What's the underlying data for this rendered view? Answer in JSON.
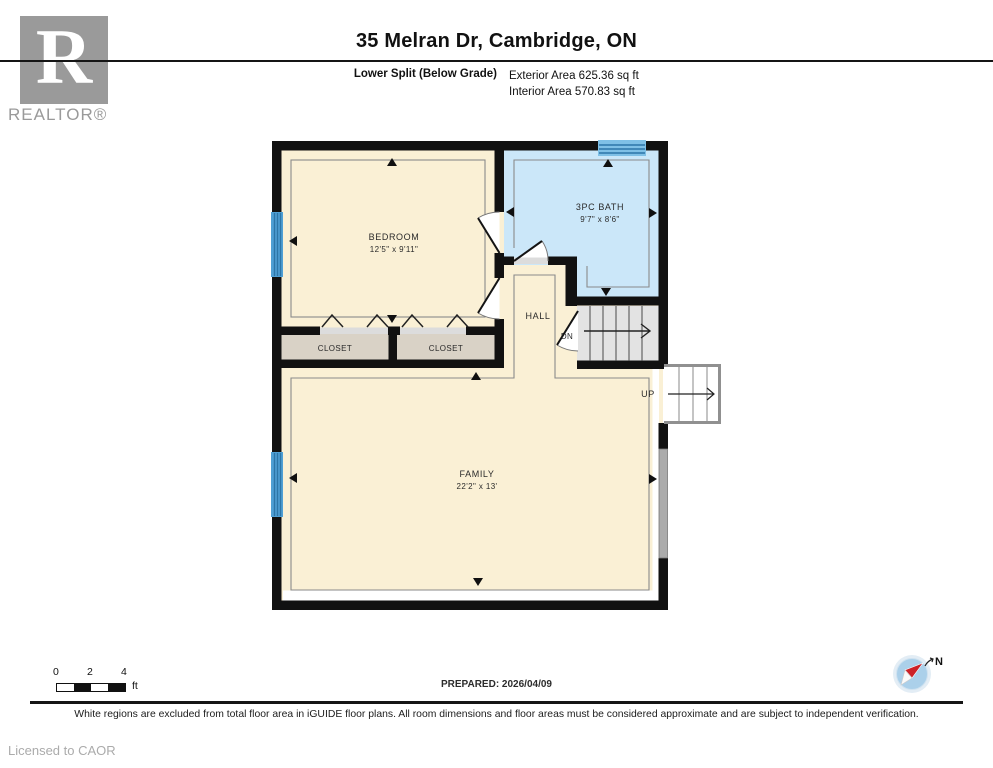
{
  "header": {
    "title": "35 Melran Dr, Cambridge, ON",
    "floor_label": "Lower Split (Below Grade)",
    "exterior_area": "Exterior Area 625.36 sq ft",
    "interior_area": "Interior Area 570.83 sq ft",
    "logo_letter": "R",
    "logo_wordmark": "REALTOR®"
  },
  "floorplan": {
    "rooms": {
      "bedroom": {
        "name": "BEDROOM",
        "dims": "12'5\" x 9'11\""
      },
      "bath": {
        "name": "3PC BATH",
        "dims": "9'7\" x 8'6\""
      },
      "family": {
        "name": "FAMILY",
        "dims": "22'2\" x 13'"
      },
      "hall": {
        "name": "HALL"
      },
      "closet_left": {
        "name": "CLOSET"
      },
      "closet_right": {
        "name": "CLOSET"
      },
      "stairs_down": {
        "label": "DN"
      },
      "stairs_up": {
        "label": "UP"
      }
    }
  },
  "footer": {
    "scale": {
      "tick0": "0",
      "tick2": "2",
      "tick4": "4",
      "unit": "ft"
    },
    "prepared": "PREPARED: 2026/04/09",
    "compass_label": "N",
    "disclaimer": "White regions are excluded from total floor area in iGUIDE floor plans. All room dimensions and floor areas must be considered approximate and are subject to independent verification.",
    "license": "Licensed to CAOR"
  },
  "colors": {
    "wall": "#111111",
    "room": "#faf0d5",
    "closet": "#d9d2c6",
    "bath": "#cbe7f9",
    "window": "#4f9fd4",
    "window_stripe": "#2d76a8",
    "stair": "#e3e3e3",
    "patio_door": "#ababab",
    "outline": "#8a8a8a",
    "excluded": "#ffffff",
    "compass_red": "#cc2127",
    "compass_blue": "#abd0ea",
    "logo_gray": "#9a9a9a"
  }
}
